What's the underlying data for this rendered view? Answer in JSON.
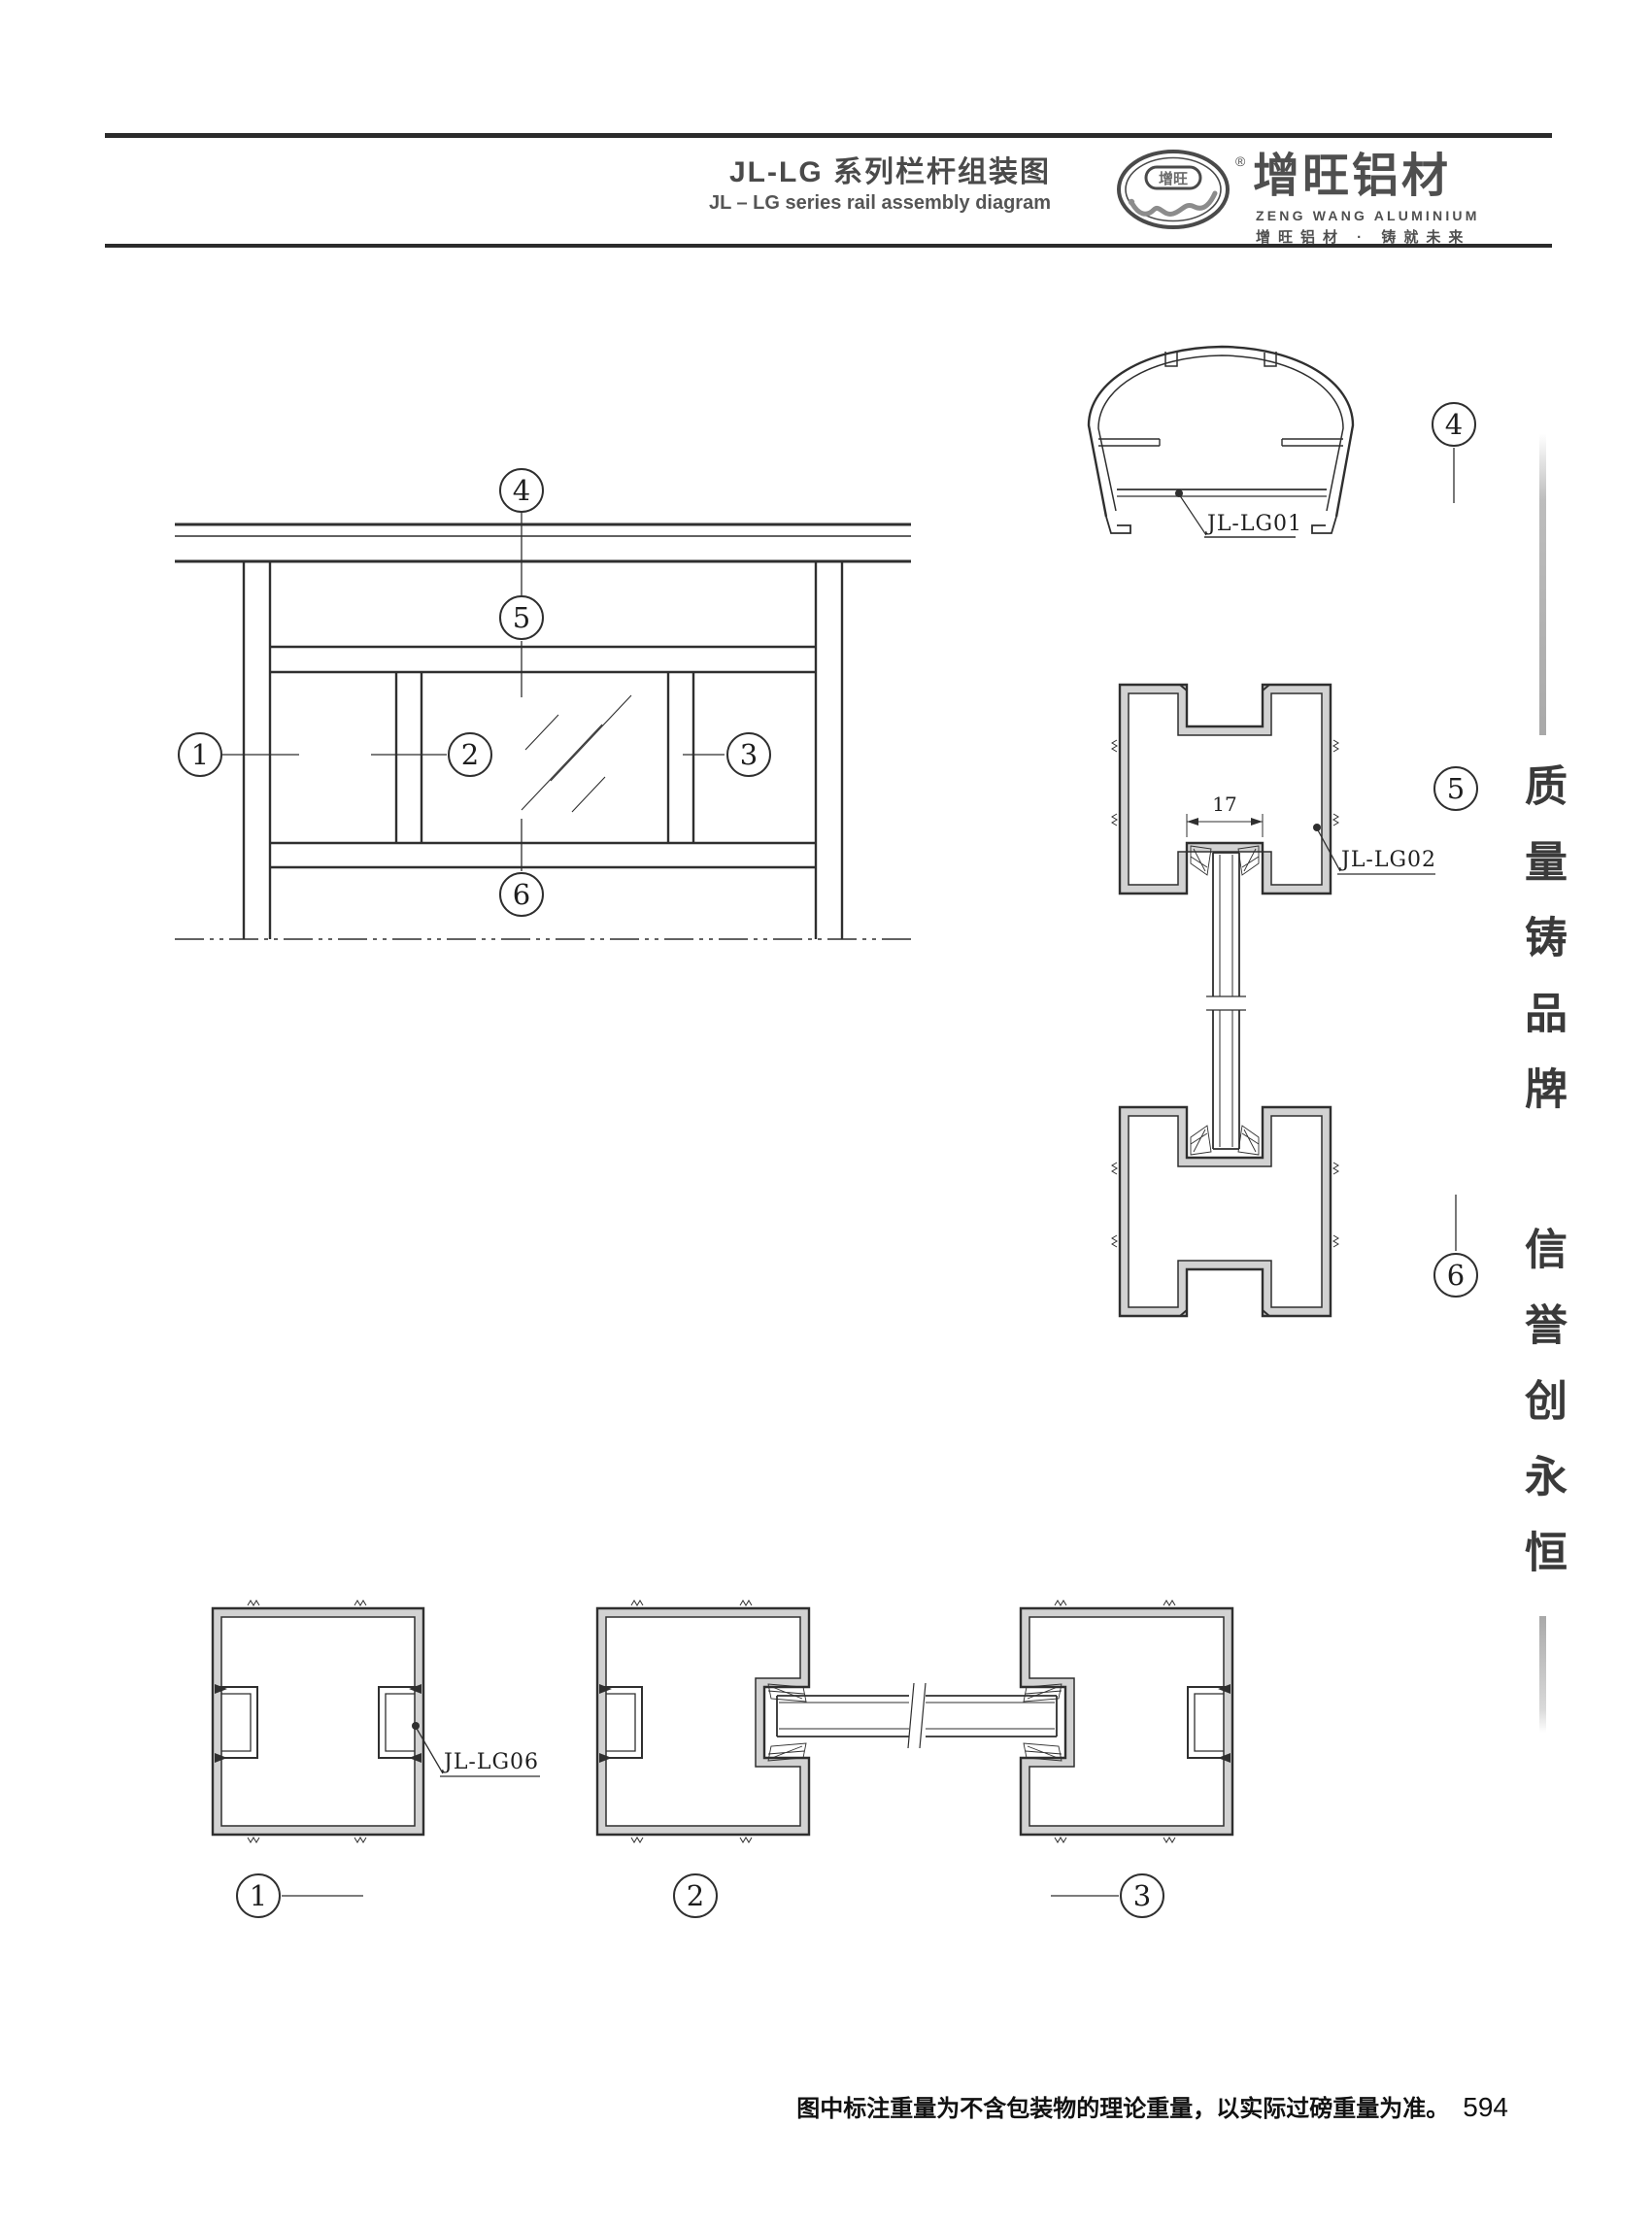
{
  "header": {
    "title_zh": "JL-LG 系列栏杆组装图",
    "title_en": "JL – LG series rail assembly diagram",
    "brand": {
      "logo_text": "增旺",
      "registered": "®",
      "name_zh": "增旺铝材",
      "name_en": "ZENG WANG ALUMINIUM",
      "slogan": "增旺铝材 · 铸就未来"
    }
  },
  "drawing": {
    "callouts": {
      "n1": "1",
      "n2": "2",
      "n3": "3",
      "n4": "4",
      "n5": "5",
      "n6": "6"
    },
    "part_labels": {
      "lg01": "JL-LG01",
      "lg02": "JL-LG02",
      "lg06": "JL-LG06"
    },
    "dimensions": {
      "glass_slot_width": "17"
    }
  },
  "sidebar": {
    "slogan_top": "质量铸品牌",
    "slogan_bottom": "信誉创永恒"
  },
  "footer": {
    "note": "图中标注重量为不含包装物的理论重量，以实际过磅重量为准。",
    "page_number": "594"
  },
  "colors": {
    "line": "#2f2f2f",
    "wall_fill": "#d2d2d2",
    "ink": "#4a4a4a"
  }
}
